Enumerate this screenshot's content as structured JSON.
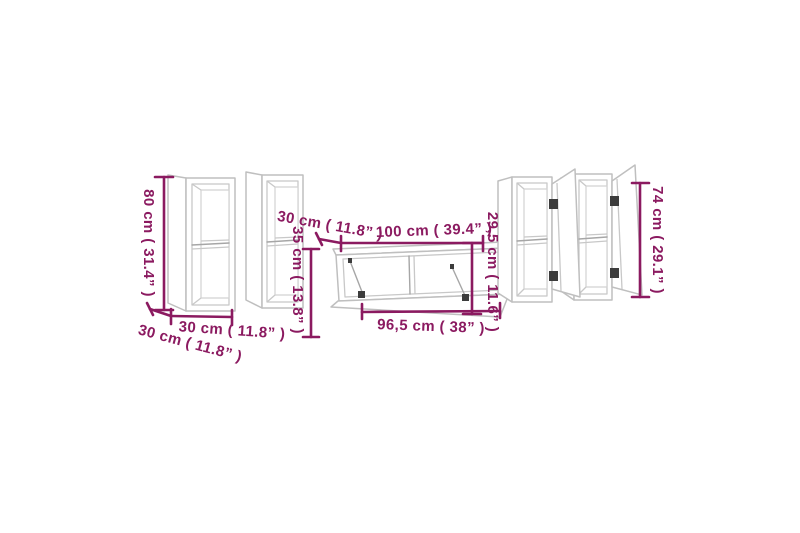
{
  "image": {
    "kind": "furniture-dimension-diagram",
    "subject": "5-piece TV cabinet wall set, wireframe drawing with measurements",
    "background_color": "#ffffff"
  },
  "colors": {
    "dimension_annotation": "#8b1a60",
    "furniture_outline": "#bfbfbf",
    "hinge": "#3c3c3c"
  },
  "annotations": {
    "wall_cabinet_small": {
      "height_label": "80 cm ( 31.4” )",
      "width_label": "30 cm ( 11.8” )",
      "depth_label": "30 cm ( 11.8” )"
    },
    "tv_stand": {
      "top_width_label": "100 cm ( 39.4” )",
      "depth_label": "30 cm ( 11.8” )",
      "height_label": "35 cm ( 13.8” )",
      "front_height_label": "29,5 cm ( 11.6” )",
      "bottom_width_label": "96,5 cm ( 38” )"
    },
    "wall_cabinet_tall": {
      "height_label": "74 cm ( 29.1” )"
    }
  }
}
